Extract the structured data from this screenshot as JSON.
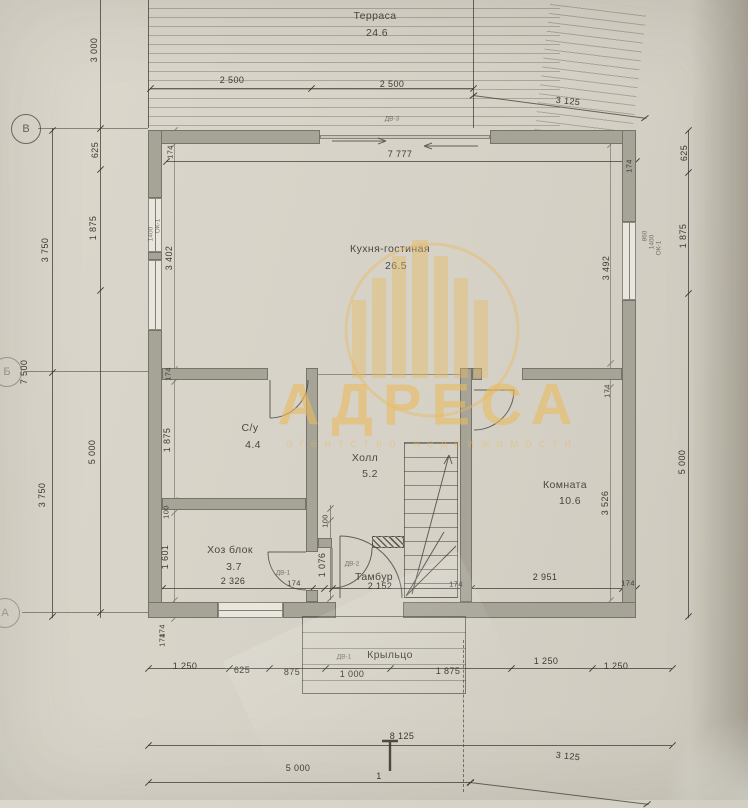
{
  "watermark": {
    "title": "АДРЕСА",
    "subtitle": "агентство недвижимости",
    "accent_color": "#e9ba5e"
  },
  "rooms": {
    "terrace": {
      "name": "Терраса",
      "area": "24.6"
    },
    "kitchen": {
      "name": "Кухня-гостиная",
      "area": "26.5"
    },
    "bathroom": {
      "name": "С/у",
      "area": "4.4"
    },
    "hall": {
      "name": "Холл",
      "area": "5.2"
    },
    "room": {
      "name": "Комната",
      "area": "10.6"
    },
    "utility": {
      "name": "Хоз блок",
      "area": "3.7"
    },
    "vestibule": {
      "name": "Тамбур"
    },
    "porch": {
      "name": "Крыльцо"
    }
  },
  "dims": {
    "t2500a": "2 500",
    "t2500b": "2 500",
    "t3125": "3 125",
    "t7777": "7 777",
    "l3000": "3 000",
    "l625": "625",
    "l1875": "1 875",
    "l3750a": "3 750",
    "l7500": "7 500",
    "l5000": "5 000",
    "l3750b": "3 750",
    "li174a": "174",
    "li3402": "3 402",
    "li174b": "174",
    "li1875": "1 875",
    "li100": "100",
    "li1601": "1 601",
    "li174c": "174",
    "r625": "625",
    "r1875": "1 875",
    "r5000": "5 000",
    "ri174a": "174",
    "ri3492": "3 492",
    "ri174b": "174",
    "ri3526": "3 526",
    "m2326": "2 326",
    "m174a": "174",
    "m100": "100",
    "m1076": "1 076",
    "m2152": "2 152",
    "m174b": "174",
    "m2951": "2 951",
    "m174c": "174",
    "b174": "174",
    "b1250a": "1 250",
    "b625": "625",
    "b875": "875",
    "b1000": "1 000",
    "b1875": "1 875",
    "b1250b": "1 250",
    "b1250c": "1 250",
    "b8125": "8 125",
    "b5000": "5 000",
    "b3125": "3 125"
  },
  "marks": {
    "dv1": "ДВ-1",
    "dv1b": "ДВ-1",
    "dv2": "ДВ-2",
    "dv3": "ДВ-3",
    "ok1a": "ОК-1",
    "ok1b": "ОК-1",
    "n1400a": "1400",
    "n1400b": "1400",
    "n860": "860"
  },
  "axes": {
    "top": "В",
    "middle": "Б",
    "bottom": "А",
    "section": "1"
  }
}
